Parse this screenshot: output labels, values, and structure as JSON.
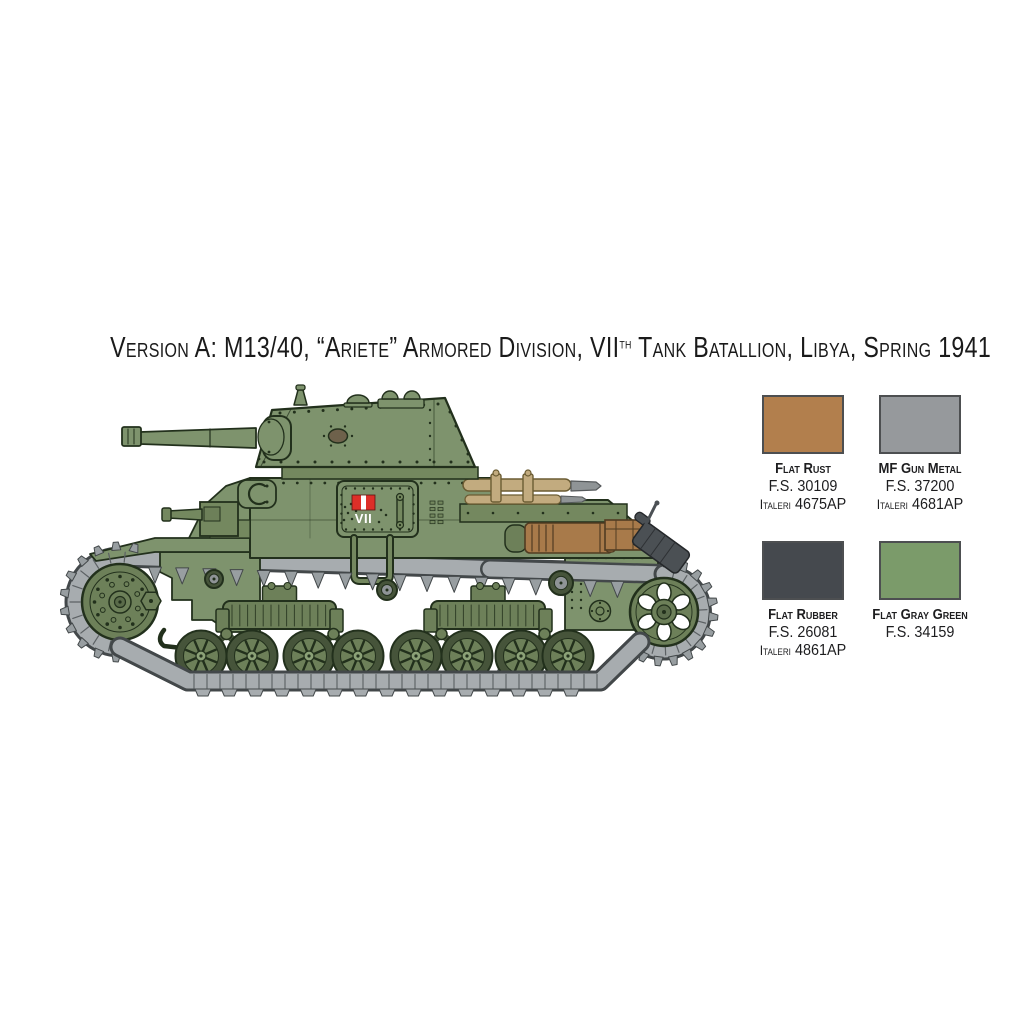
{
  "title": {
    "part1": "Version A: M13/40, “Ariete” Armored Division, VII",
    "sup": "th",
    "part2": " Tank Batallion, Libya, Spring 1941"
  },
  "tank_marking": {
    "numeral": "VII"
  },
  "palette": {
    "swatches": [
      {
        "name": "Flat Rust",
        "fs": "F.S. 30109",
        "brand": "Italeri",
        "code": "4675AP",
        "color": "#b27f4d"
      },
      {
        "name": "MF Gun Metal",
        "fs": "F.S. 37200",
        "brand": "Italeri",
        "code": "4681AP",
        "color": "#96999c"
      },
      {
        "name": "Flat Rubber",
        "fs": "F.S. 26081",
        "brand": "Italeri",
        "code": "4861AP",
        "color": "#45494e"
      },
      {
        "name": "Flat Gray Green",
        "fs": "F.S. 34159",
        "brand": "",
        "code": "",
        "color": "#7b9b6a"
      }
    ]
  }
}
